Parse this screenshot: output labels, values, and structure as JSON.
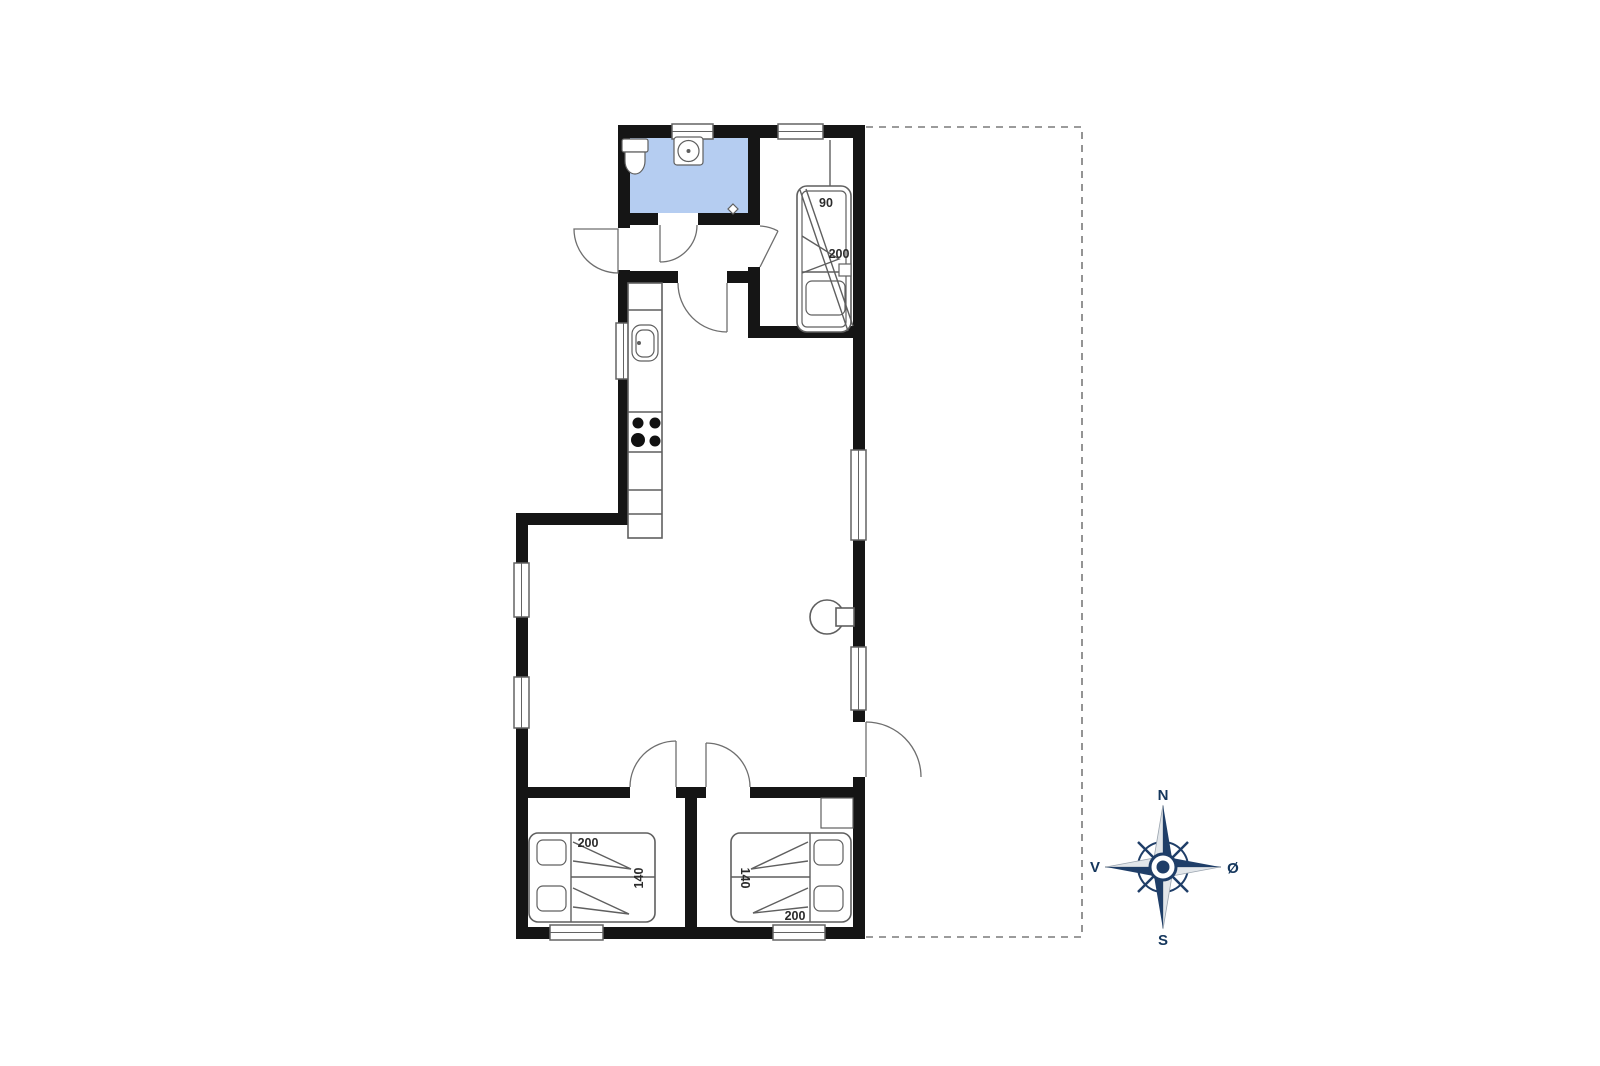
{
  "document": {
    "type": "floor-plan",
    "background": "#ffffff"
  },
  "colors": {
    "wall": "#151515",
    "furniture_line": "#5f5f5f",
    "bathroom_floor": "#b5cdf1",
    "compass_navy": "#1f3e68",
    "compass_light": "#e2e6ea",
    "label_text": "#2b2b2b",
    "dashed_outline": "#7a7a7a"
  },
  "rooms": {
    "bathroom": {
      "fixtures": [
        "toilet",
        "washbasin",
        "floor-drain"
      ]
    },
    "bunk_room": {
      "bed_width_label": "90",
      "bed_length_label": "200"
    },
    "kitchen": {
      "fixtures": [
        "sink",
        "stove-4-burners",
        "counter"
      ]
    },
    "living_room": {
      "fixtures": [
        "wood-stove"
      ]
    },
    "bedroom_left": {
      "bed_length_label": "200",
      "bed_width_label": "140"
    },
    "bedroom_right": {
      "bed_width_label": "140",
      "bed_length_label": "200"
    }
  },
  "terrace": {
    "outline": "dashed"
  },
  "compass": {
    "north": "N",
    "south": "S",
    "west": "V",
    "east": "Ø"
  }
}
